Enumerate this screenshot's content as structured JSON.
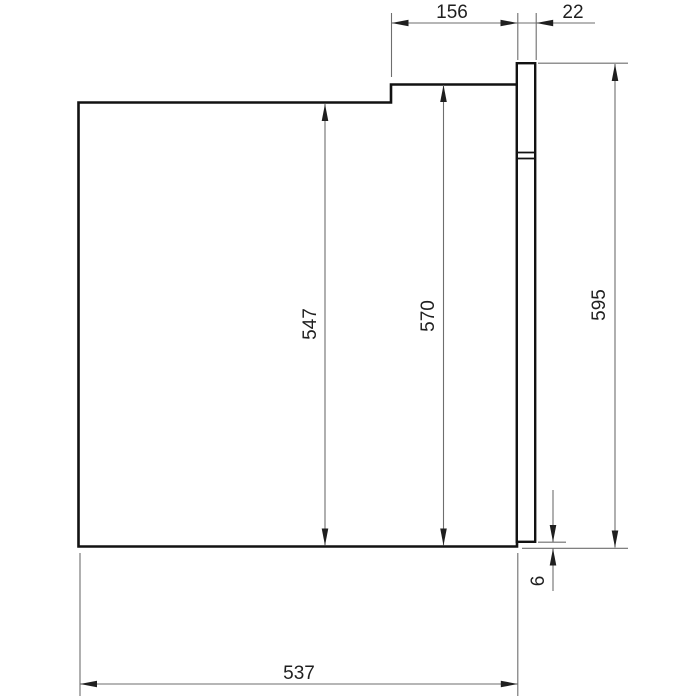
{
  "drawing": {
    "kind": "technical-dimension-drawing",
    "subject": "built-in-oven-side-elevation",
    "dimensions": {
      "recess_depth": "156",
      "door_thickness": "22",
      "rear_height": "547",
      "front_height": "570",
      "overall_height": "595",
      "door_overhang": "6",
      "body_depth": "537"
    },
    "colors": {
      "background": "#ffffff",
      "outline": "#121212",
      "dimension_line": "#6e6e6e",
      "arrow": "#1f1f1f",
      "text": "#1f1f1f"
    }
  }
}
